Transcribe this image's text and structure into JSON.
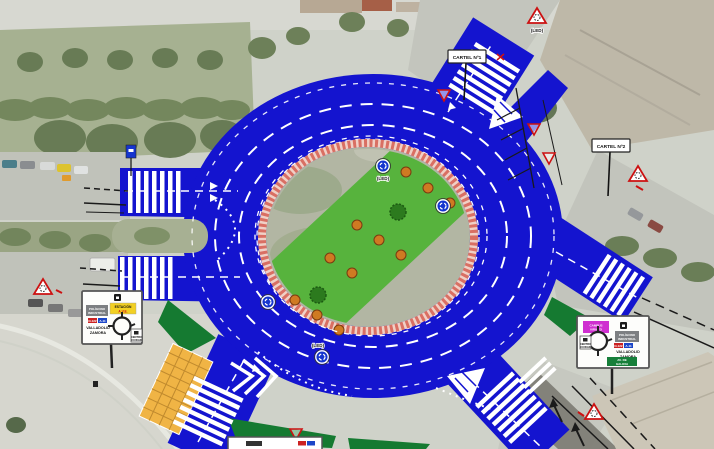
{
  "labels": {
    "led": "(LED)",
    "cartel_1": "CARTEL Nº1",
    "cartel_2": "CARTEL Nº2"
  },
  "left_board": {
    "yellow_1": "ESTACIÓN",
    "yellow_2": "A.V.E.",
    "gray_1": "POLÍGONO",
    "gray_2": "INDUSTRIAL",
    "shield_red": "N-122",
    "shield_blue": "A-11",
    "dest_1": "VALLADOLID",
    "dest_2": "ZAMORA",
    "white_1": "CENTRO",
    "white_2": "CIUDAD"
  },
  "right_board": {
    "magenta_1": "CAMPUS",
    "magenta_2": "VIRIATO",
    "gray_1": "POLÍGONO",
    "gray_2": "INDUSTRIAL",
    "shield_red": "N-122",
    "shield_blue": "A-11",
    "dest_1": "VALLADOLID",
    "dest_2": "ZAMORA",
    "white_1": "CENTRO",
    "white_2": "CIUDAD",
    "green_1": "AV. DE",
    "green_2": "GALICIA"
  },
  "colors": {
    "road_blue": "#1414cf",
    "island_band_green": "#57b33d",
    "verge_green": "#157a31",
    "hatch_orange": "#f0b445",
    "brick_pink": "#d96f63",
    "warning_red": "#cc1111"
  }
}
